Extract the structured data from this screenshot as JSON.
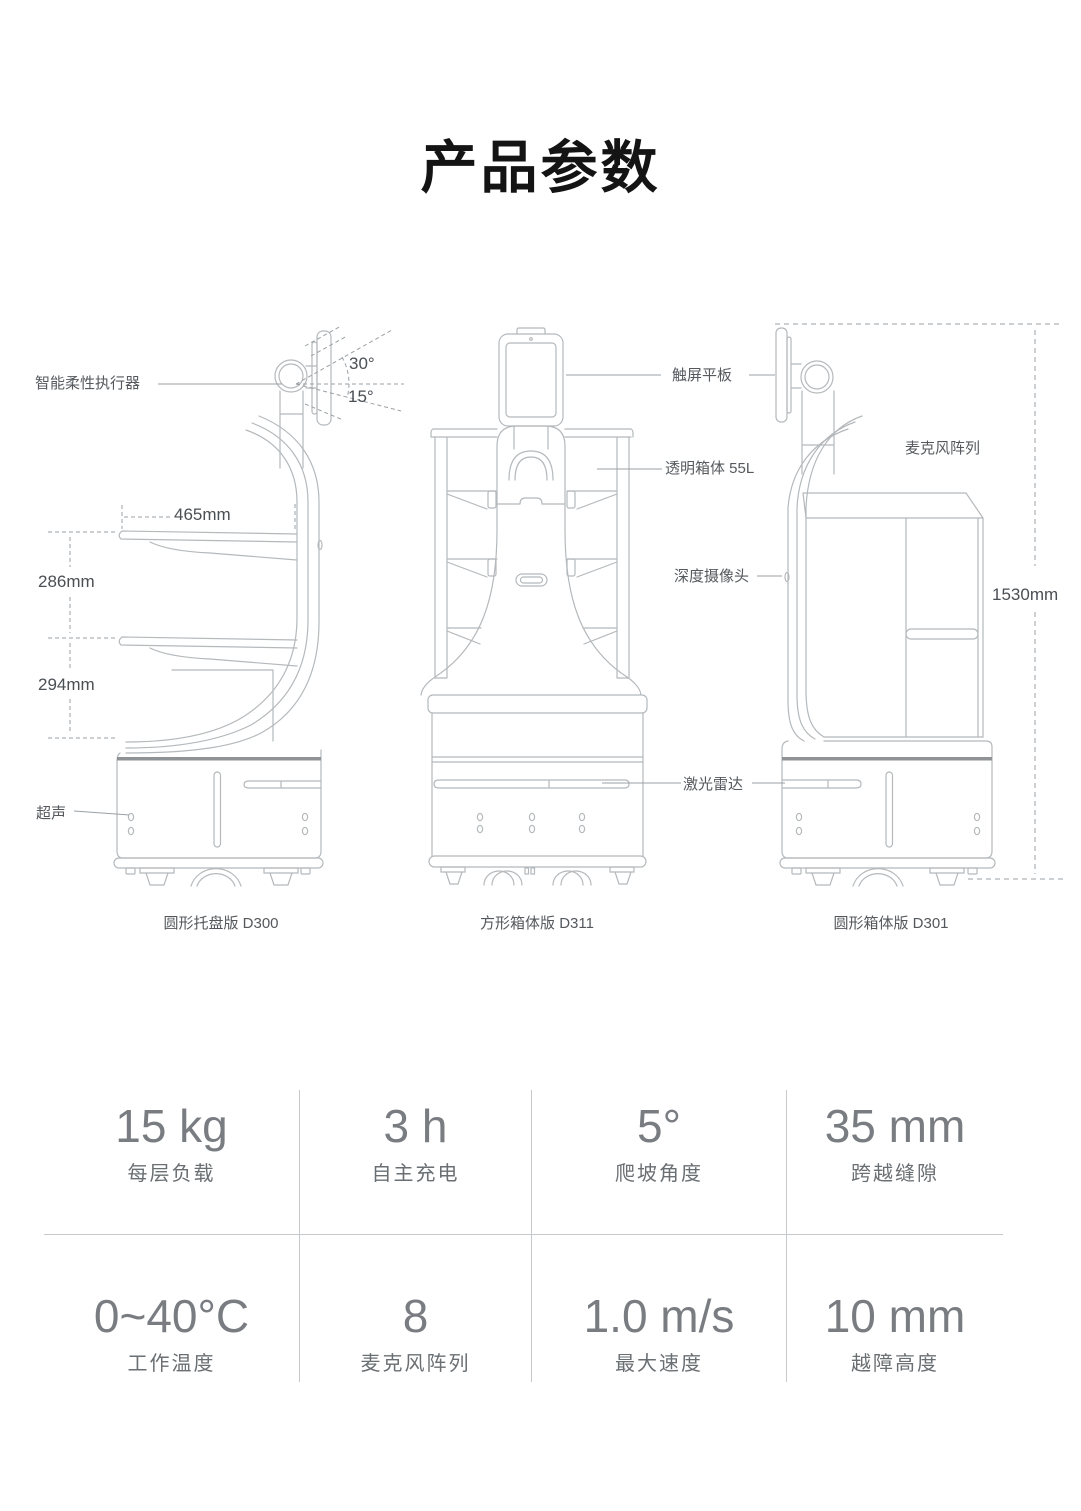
{
  "title": "产品参数",
  "diagram": {
    "annotations": {
      "actuator": "智能柔性执行器",
      "angle_up": "30°",
      "angle_down": "15°",
      "dim_tray_width": "465mm",
      "dim_gap_upper": "286mm",
      "dim_gap_lower": "294mm",
      "ultrasonic": "超声",
      "tablet": "触屏平板",
      "cabinet": "透明箱体 55L",
      "depth_camera": "深度摄像头",
      "lidar": "激光雷达",
      "mic_array": "麦克风阵列",
      "dim_height": "1530mm"
    },
    "robots": [
      {
        "caption": "圆形托盘版 D300"
      },
      {
        "caption": "方形箱体版 D311"
      },
      {
        "caption": "圆形箱体版 D301"
      }
    ]
  },
  "specs": {
    "rows": [
      [
        {
          "value": "15 kg",
          "label": "每层负载"
        },
        {
          "value": "3 h",
          "label": "自主充电"
        },
        {
          "value": "5°",
          "label": "爬坡角度"
        },
        {
          "value": "35 mm",
          "label": "跨越缝隙"
        }
      ],
      [
        {
          "value": "0~40°C",
          "label": "工作温度"
        },
        {
          "value": "8",
          "label": "麦克风阵列"
        },
        {
          "value": "1.0 m/s",
          "label": "最大速度"
        },
        {
          "value": "10 mm",
          "label": "越障高度"
        }
      ]
    ]
  },
  "colors": {
    "line_art": "#b5b9bc",
    "dark_band": "#8f9396",
    "dashed_dim": "#9aa0a4",
    "label_text": "#55595e",
    "spec_value": "#797d81",
    "divider": "#c6c9cb",
    "title_text": "#141414"
  }
}
